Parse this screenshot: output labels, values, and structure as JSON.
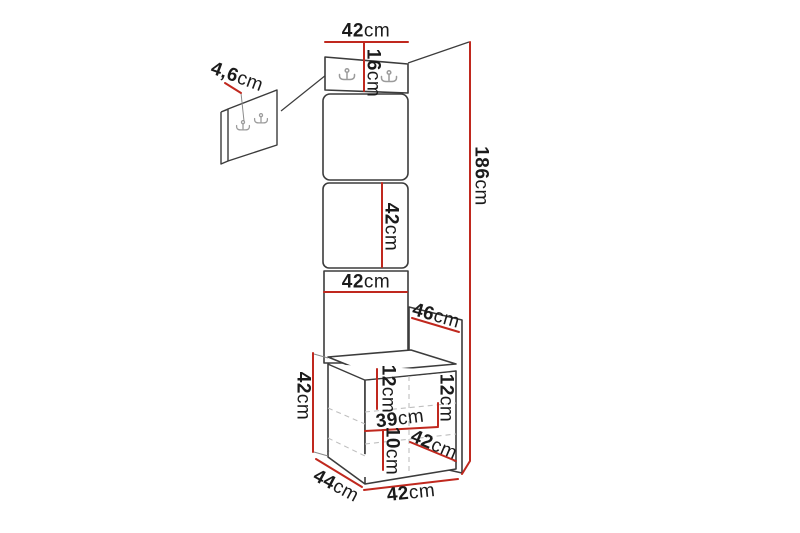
{
  "colors": {
    "background": "#ffffff",
    "dimension_line": "#c0281e",
    "outline": "#3c3c3c",
    "hidden_edge": "#bfbfbf",
    "hook": "#9b9b9b",
    "label_text": "#1b1b1b"
  },
  "icons": {
    "coat_hook": "double-prong-wall-hook"
  },
  "labels": {
    "top_width": {
      "value": "42",
      "unit": "cm"
    },
    "hook_panel_height": {
      "value": "16",
      "unit": "cm"
    },
    "wall_panel_thickness": {
      "value": "4,6",
      "unit": "cm"
    },
    "total_height": {
      "value": "186",
      "unit": "cm"
    },
    "cushion_height": {
      "value": "42",
      "unit": "cm"
    },
    "panel_width": {
      "value": "42",
      "unit": "cm"
    },
    "side_panel_depth": {
      "value": "46",
      "unit": "cm"
    },
    "bench_height": {
      "value": "42",
      "unit": "cm"
    },
    "bench_inner_left": {
      "value": "12",
      "unit": "cm"
    },
    "bench_inner_right": {
      "value": "12",
      "unit": "cm"
    },
    "bench_inner_width": {
      "value": "39",
      "unit": "cm"
    },
    "bench_inner_bottom": {
      "value": "10",
      "unit": "cm"
    },
    "bench_top_width": {
      "value": "42",
      "unit": "cm"
    },
    "bench_depth": {
      "value": "44",
      "unit": "cm"
    },
    "bench_bottom_width": {
      "value": "42",
      "unit": "cm"
    }
  }
}
